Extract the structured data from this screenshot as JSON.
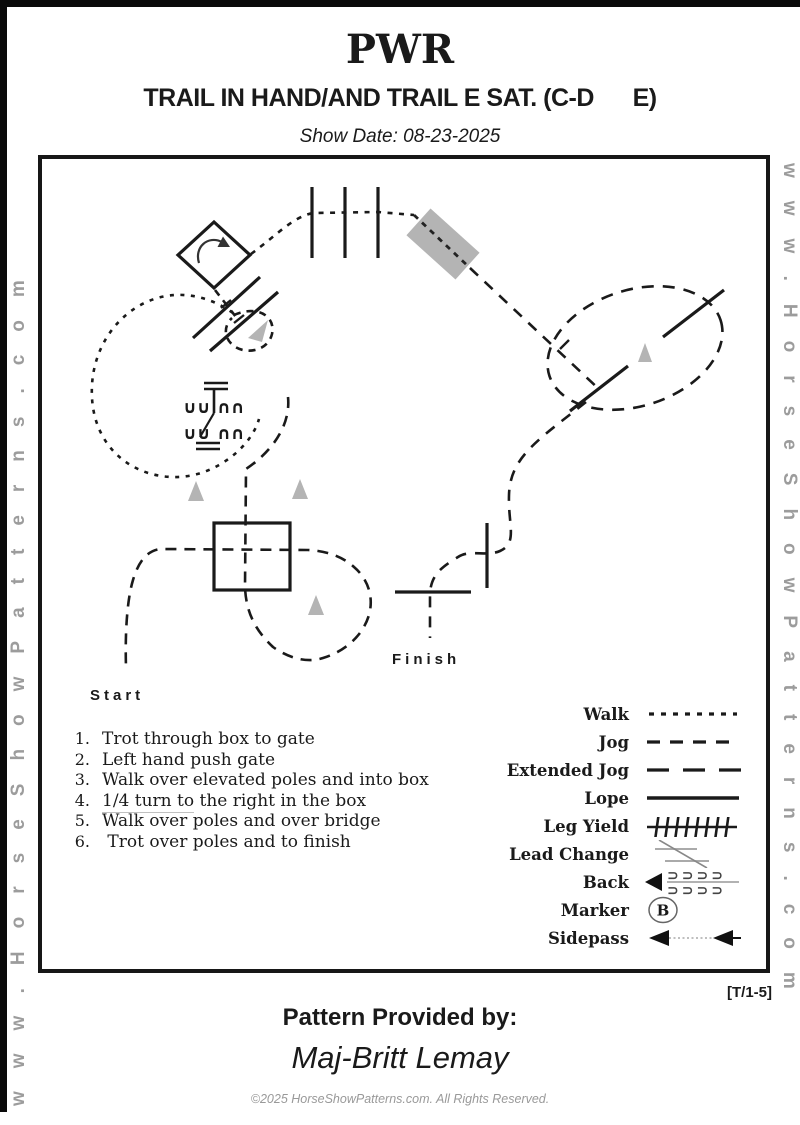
{
  "header": {
    "title": "PWR",
    "subtitle": "TRAIL IN HAND/AND TRAIL E SAT. (C-D      E)",
    "show_date": "Show Date: 08-23-2025"
  },
  "watermark": {
    "left": "www.HorseShowPatterns.com",
    "right": "www.HorseShowPatterns.com"
  },
  "pattern": {
    "start_label": "Start",
    "finish_label": "Finish",
    "gate_glyphs": {
      "r1a": "∪∪",
      "r1b": "∩∩",
      "r2a": "∪∪",
      "r2b": "∩∩"
    }
  },
  "instructions": [
    {
      "num": "1.",
      "u": "",
      "text": "Trot through box to gate"
    },
    {
      "num": "2.",
      "u": "",
      "text": "Left hand push gate"
    },
    {
      "num": "3.",
      "u": "",
      "text": "Walk over elevated poles and into box"
    },
    {
      "num": "4.",
      "u": "1/4 turn to",
      "text": " the right in the box"
    },
    {
      "num": "5.",
      "u": "",
      "text": "Walk over poles and over bridge"
    },
    {
      "num": "6.",
      "u": "",
      "text": " Trot over poles and to finish"
    }
  ],
  "legend": {
    "marker_letter": "B",
    "back_cups_row1": "⊃⊃⊃⊃",
    "back_cups_row2": "⊃⊃⊃⊃",
    "items": [
      {
        "label": "Walk"
      },
      {
        "label": "Jog"
      },
      {
        "label": "Extended Jog"
      },
      {
        "label": "Lope"
      },
      {
        "label": "Leg Yield"
      },
      {
        "label": "Lead Change"
      },
      {
        "label": "Back"
      },
      {
        "label": "Marker"
      },
      {
        "label": "Sidepass"
      }
    ]
  },
  "footer": {
    "pattern_code": "[T/1-5]",
    "provided_by": "Pattern Provided by:",
    "provider_name": "Maj-Britt Lemay",
    "copyright": "©2025 HorseShowPatterns.com. All Rights Reserved."
  },
  "colors": {
    "ink": "#1a1a1a",
    "gray_fill": "#b4b4b4",
    "watermark": "#9c9c9c"
  }
}
